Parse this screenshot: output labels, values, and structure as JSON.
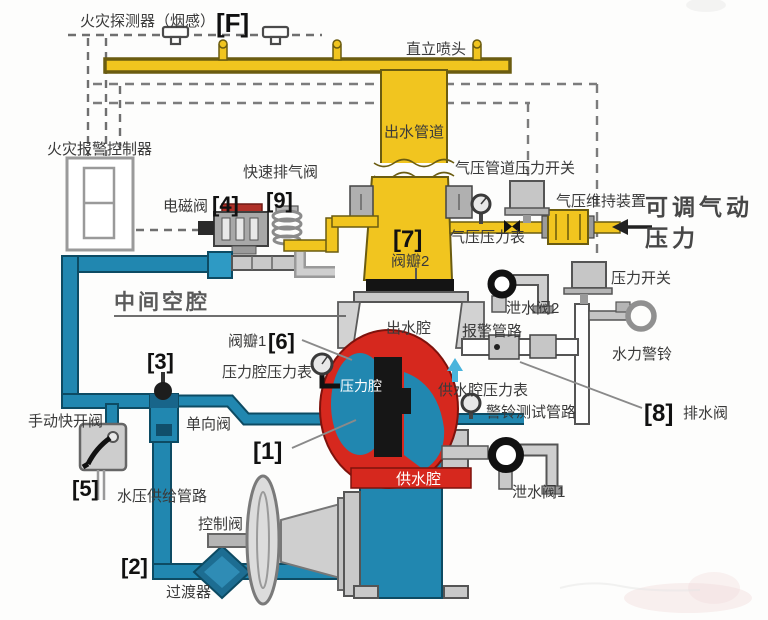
{
  "colors": {
    "pipe_yellow": "#f1c51f",
    "pipe_yellow_dark": "#6b5c10",
    "pipe_blue": "#2187b0",
    "pipe_blue_dark": "#0d4b63",
    "valve_red": "#d6281e",
    "valve_red_dark": "#7e120c",
    "metal_light": "#c9c9c9",
    "metal_dark": "#555555",
    "text": "#3a3a3a"
  },
  "labels": {
    "fire_detector": "火灾探测器（烟感）",
    "marker_f": "[F]",
    "upright_sprinkler": "直立喷头",
    "outlet_pipe": "出水管道",
    "fire_alarm_controller": "火灾报警控制器",
    "quick_exhaust_valve": "快速排气阀",
    "marker_9": "[9]",
    "solenoid_valve": "电磁阀",
    "marker_4": "[4]",
    "air_pipe_pressure_switch": "气压管道压力开关",
    "air_maintenance_device": "气压维持装置",
    "adjustable_air_1": "可调气动",
    "adjustable_air_2": "压力",
    "marker_7": "[7]",
    "valve_disc_2": "阀瓣2",
    "air_pressure_gauge": "气压压力表",
    "pressure_switch": "压力开关",
    "middle_cavity": "中间空腔",
    "outlet_chamber": "出水腔",
    "drain_valve_2": "泄水阀2",
    "alarm_pipeline": "报警管路",
    "water_alarm_bell": "水力警铃",
    "valve_disc_1": "阀瓣1",
    "marker_6": "[6]",
    "marker_3": "[3]",
    "pressure_chamber_gauge": "压力腔压力表",
    "pressure_chamber": "压力腔",
    "supply_chamber_gauge": "供水腔压力表",
    "bell_test_pipeline": "警铃测试管路",
    "marker_8": "[8]",
    "drain_valve_main": "排水阀",
    "manual_quick_open_valve": "手动快开阀",
    "check_valve": "单向阀",
    "marker_1": "[1]",
    "supply_chamber": "供水腔",
    "marker_5": "[5]",
    "water_supply_pipeline": "水压供给管路",
    "drain_valve_1": "泄水阀1",
    "control_valve": "控制阀",
    "marker_2": "[2]",
    "transition_device": "过渡器"
  }
}
